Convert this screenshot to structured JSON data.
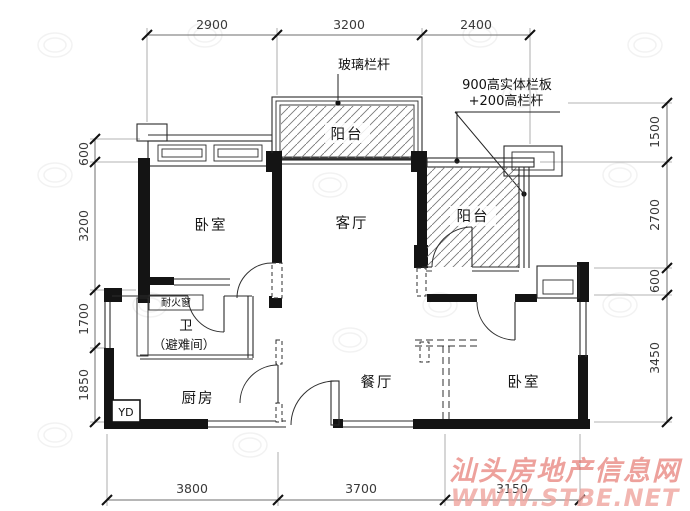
{
  "dimensions": {
    "top": [
      "2900",
      "3200",
      "2400"
    ],
    "bottom": [
      "3800",
      "3700",
      "3150"
    ],
    "left": [
      "600",
      "3200",
      "1700",
      "1850"
    ],
    "right": [
      "1500",
      "2700",
      "600",
      "3450"
    ]
  },
  "rooms": {
    "bedroom_left": "卧室",
    "living_room": "客厅",
    "balcony_top": "阳台",
    "balcony_right": "阳台",
    "bathroom": "卫",
    "bathroom_note": "（避难间）",
    "kitchen": "厨房",
    "dining_room": "餐厅",
    "bedroom_right": "卧室"
  },
  "annotations": {
    "glass_railing": "玻璃栏杆",
    "solid_railing_line1": "900高实体栏板",
    "solid_railing_line2": "+200高栏杆",
    "fire_window": "耐火窗",
    "power_box": "YD"
  },
  "watermark": {
    "site_name": "汕头房地产信息网",
    "site_url": "WWW.STBE.NET",
    "color": "#e0554c"
  }
}
